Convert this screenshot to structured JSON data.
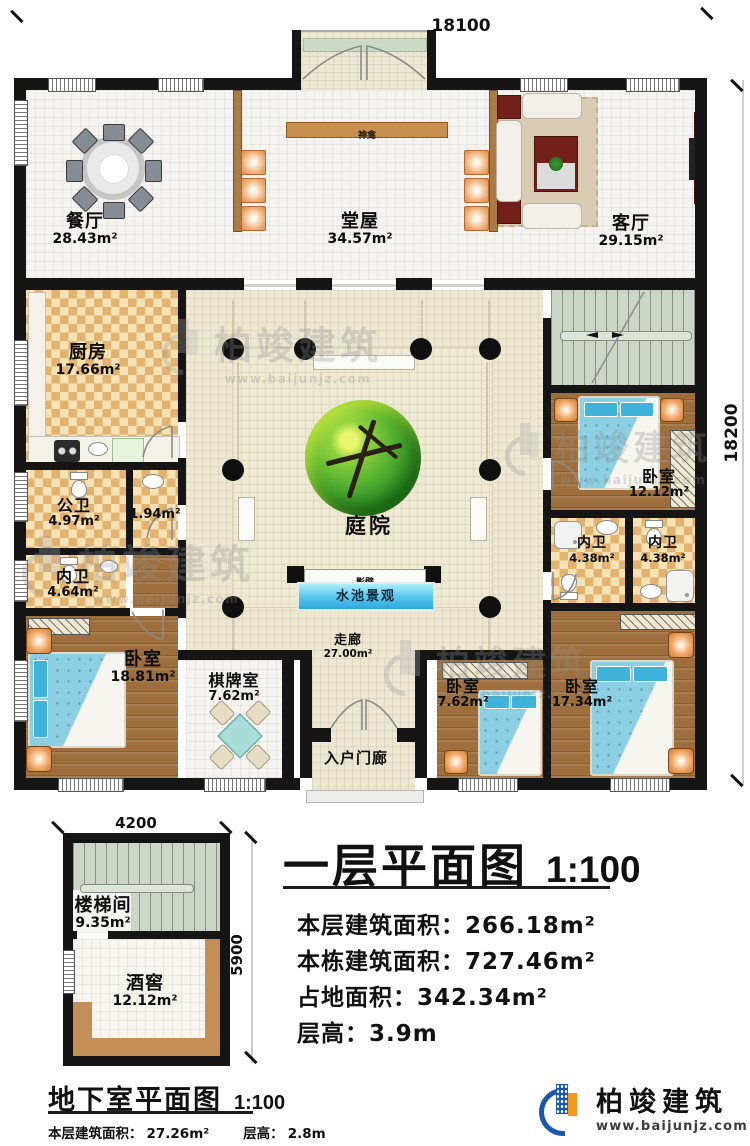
{
  "dims": {
    "main_top": "18100",
    "main_right": "18200",
    "base_top": "4200",
    "base_right": "5900"
  },
  "rooms": {
    "dining": {
      "name": "餐厅",
      "area": "28.43m²"
    },
    "hall": {
      "name": "堂屋",
      "area": "34.57m²"
    },
    "living": {
      "name": "客厅",
      "area": "29.15m²"
    },
    "shrine": {
      "name": "神龛"
    },
    "kitchen": {
      "name": "厨房",
      "area": "17.66m²"
    },
    "public_bath": {
      "name": "公卫",
      "area": "4.97m²"
    },
    "store": {
      "area": "1.94m²"
    },
    "inner_bath_w": {
      "name": "内卫",
      "area": "4.64m²"
    },
    "bedroom_sw": {
      "name": "卧室",
      "area": "18.81m²"
    },
    "chess": {
      "name": "棋牌室",
      "area": "7.62m²"
    },
    "entry_porch": {
      "name": "入户门廊"
    },
    "bedroom_s1": {
      "name": "卧室",
      "area": "7.62m²"
    },
    "bedroom_s2": {
      "name": "卧室",
      "area": "17.34m²"
    },
    "bedroom_e": {
      "name": "卧室",
      "area": "12.12m²"
    },
    "inner_bath_e1": {
      "name": "内卫",
      "area": "4.38m²"
    },
    "inner_bath_e2": {
      "name": "内卫",
      "area": "4.38m²"
    },
    "courtyard": {
      "name": "庭院"
    },
    "screen_wall": {
      "name": "影壁"
    },
    "pool": {
      "name": "水池景观"
    },
    "corridor": {
      "name": "走廊",
      "area": "27.00m²"
    }
  },
  "basement_rooms": {
    "stairwell": {
      "name": "楼梯间",
      "area": "9.35m²"
    },
    "cellar": {
      "name": "酒窖",
      "area": "12.12m²"
    }
  },
  "floor_title": {
    "text": "一层平面图",
    "scale": "1:100"
  },
  "floor_info": [
    {
      "label": "本层建筑面积：",
      "value": "266.18m²"
    },
    {
      "label": "本栋建筑面积：",
      "value": "727.46m²"
    },
    {
      "label": "占地面积：",
      "value": "342.34m²"
    },
    {
      "label": "层高：",
      "value": "3.9m"
    }
  ],
  "basement_title": {
    "text": "地下室平面图",
    "scale": "1:100"
  },
  "basement_info": [
    {
      "label": "本层建筑面积：",
      "value": "27.26m²"
    },
    {
      "label": "层高：",
      "value": "2.8m"
    }
  ],
  "brand": {
    "name": "柏竣建筑",
    "url": "www.baijunjz.com"
  },
  "watermark": {
    "text": "柏竣建筑",
    "url": "www.baijunjz.com"
  },
  "colors": {
    "wall": "#151515",
    "wood": "#9e6f3c",
    "checker": "#e2b26e",
    "cream": "#ece7d2",
    "pool": "#3ab0e0",
    "stairs": "#ccd5c8",
    "brand_blue": "#1a57ae",
    "brand_orange": "#f59a1d",
    "bed": "#85cade"
  }
}
